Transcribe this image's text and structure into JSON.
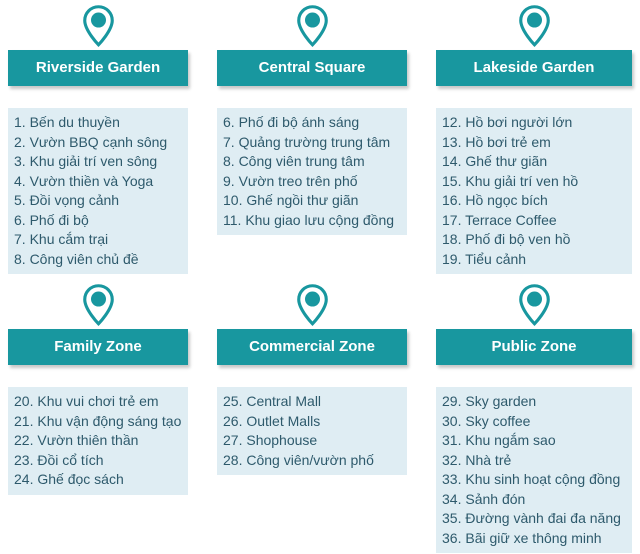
{
  "colors": {
    "teal": "#18979F",
    "list_bg": "#DFEDF3",
    "list_text": "#2E5A6C",
    "header_text": "#FFFFFF"
  },
  "zones": [
    {
      "name": "Riverside Garden",
      "items": [
        "1. Bến du thuyền",
        "2. Vườn BBQ cạnh sông",
        "3. Khu giải trí ven sông",
        "4. Vườn thiền và Yoga",
        "5. Đồi vọng cảnh",
        "6. Phố đi bộ",
        "7. Khu cắm trại",
        "8. Công viên chủ đề"
      ]
    },
    {
      "name": "Central Square",
      "items": [
        "6. Phố đi bộ ánh sáng",
        "7. Quảng trường trung tâm",
        "8. Công viên trung tâm",
        "9. Vườn treo trên phố",
        "10. Ghế ngồi thư giãn",
        "11. Khu giao lưu cộng đồng"
      ]
    },
    {
      "name": "Lakeside Garden",
      "items": [
        "12. Hồ bơi người lớn",
        "13. Hồ bơi trẻ em",
        "14. Ghế thư giãn",
        "15. Khu giải trí ven hồ",
        "16. Hồ ngọc bích",
        "17. Terrace Coffee",
        "18. Phố đi bộ ven hồ",
        "19. Tiểu cảnh"
      ]
    },
    {
      "name": "Family Zone",
      "items": [
        "20. Khu vui chơi trẻ em",
        "21. Khu vận động sáng tạo",
        "22. Vườn thiên thần",
        "23. Đồi cổ tích",
        "24. Ghế đọc sách"
      ]
    },
    {
      "name": "Commercial Zone",
      "items": [
        "25. Central Mall",
        "26. Outlet Malls",
        "27. Shophouse",
        "28. Công viên/vườn phố"
      ]
    },
    {
      "name": "Public Zone",
      "items": [
        "29. Sky garden",
        "30. Sky coffee",
        "31. Khu ngắm sao",
        "32. Nhà trẻ",
        "33. Khu sinh hoạt cộng đồng",
        "34. Sảnh đón",
        "35. Đường vành đai đa năng",
        "36. Bãi giữ xe thông minh"
      ]
    }
  ]
}
